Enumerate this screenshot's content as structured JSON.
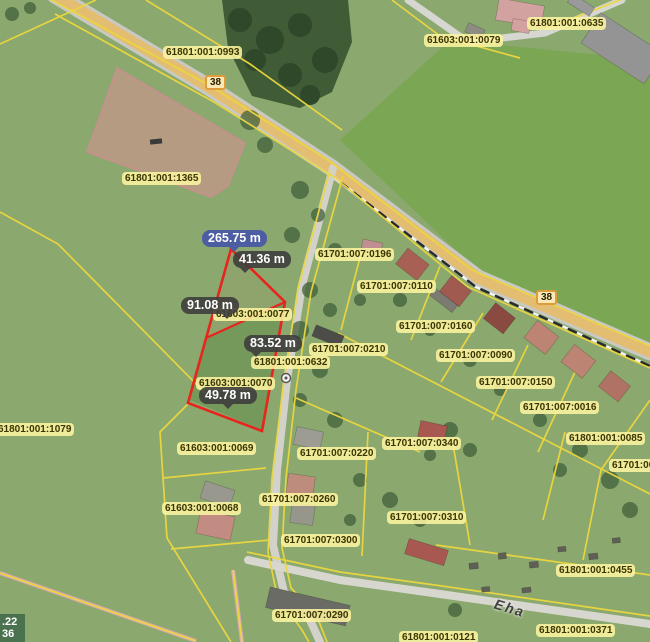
{
  "map": {
    "colors": {
      "parcel_boundary": "#ecd73f",
      "selection_outline": "#e8241c",
      "selected_measure_bg": "#4c5da1",
      "measure_bg": "#3e3e3c",
      "label_bg": "#fcf4a0",
      "highlight_parcel_fill": "#d69292",
      "highway_surface": "#e3bd72"
    },
    "parcel_labels": [
      {
        "text": "61801:001:0993",
        "x": 163,
        "y": 46
      },
      {
        "text": "61603:001:0079",
        "x": 424,
        "y": 34
      },
      {
        "text": "61801:001:0635",
        "x": 527,
        "y": 17
      },
      {
        "text": "61801:001:1365",
        "x": 122,
        "y": 172
      },
      {
        "text": "61801:001:1079",
        "x": -5,
        "y": 423
      },
      {
        "text": "61603:001:0077",
        "x": 213,
        "y": 308
      },
      {
        "text": "61801:001:0632",
        "x": 251,
        "y": 356
      },
      {
        "text": "61603:001:0070",
        "x": 196,
        "y": 377
      },
      {
        "text": "61701:007:0196",
        "x": 315,
        "y": 248
      },
      {
        "text": "61701:007:0110",
        "x": 357,
        "y": 280
      },
      {
        "text": "61701:007:0160",
        "x": 396,
        "y": 320
      },
      {
        "text": "61701:007:0210",
        "x": 309,
        "y": 343
      },
      {
        "text": "61701:007:0090",
        "x": 436,
        "y": 349
      },
      {
        "text": "61701:007:0150",
        "x": 476,
        "y": 376
      },
      {
        "text": "61701:007:0016",
        "x": 520,
        "y": 401
      },
      {
        "text": "61801:001:0085",
        "x": 566,
        "y": 432
      },
      {
        "text": "61701:00",
        "x": 609,
        "y": 459
      },
      {
        "text": "61603:001:0069",
        "x": 177,
        "y": 442
      },
      {
        "text": "61701:007:0220",
        "x": 297,
        "y": 447
      },
      {
        "text": "61701:007:0340",
        "x": 382,
        "y": 437
      },
      {
        "text": "61603:001:0068",
        "x": 162,
        "y": 502
      },
      {
        "text": "61701:007:0260",
        "x": 259,
        "y": 493
      },
      {
        "text": "61701:007:0310",
        "x": 387,
        "y": 511
      },
      {
        "text": "61701:007:0300",
        "x": 281,
        "y": 534
      },
      {
        "text": "61701:007:0290",
        "x": 272,
        "y": 609
      },
      {
        "text": "61801:001:0455",
        "x": 556,
        "y": 564
      },
      {
        "text": "61801:001:0371",
        "x": 536,
        "y": 624
      },
      {
        "text": "61801:001:0121",
        "x": 399,
        "y": 631
      }
    ],
    "measurements": [
      {
        "text": "265.75 m",
        "x": 202,
        "y": 230,
        "style": "selected",
        "pointer": "p-c"
      },
      {
        "text": "41.36 m",
        "x": 233,
        "y": 251,
        "style": "dark",
        "pointer": "p-l"
      },
      {
        "text": "91.08 m",
        "x": 181,
        "y": 297,
        "style": "dark",
        "pointer": "p-r"
      },
      {
        "text": "83.52 m",
        "x": 244,
        "y": 335,
        "style": "dark",
        "pointer": "p-l"
      },
      {
        "text": "49.78 m",
        "x": 199,
        "y": 387,
        "style": "dark",
        "pointer": "p-c"
      }
    ],
    "road_signs": [
      {
        "text": "38",
        "x": 205,
        "y": 75
      },
      {
        "text": "38",
        "x": 536,
        "y": 290
      }
    ],
    "street_label": {
      "text": "Eha",
      "x": 494,
      "y": 600
    },
    "coord_readout": {
      "line1": ".22",
      "line2": "36"
    }
  }
}
